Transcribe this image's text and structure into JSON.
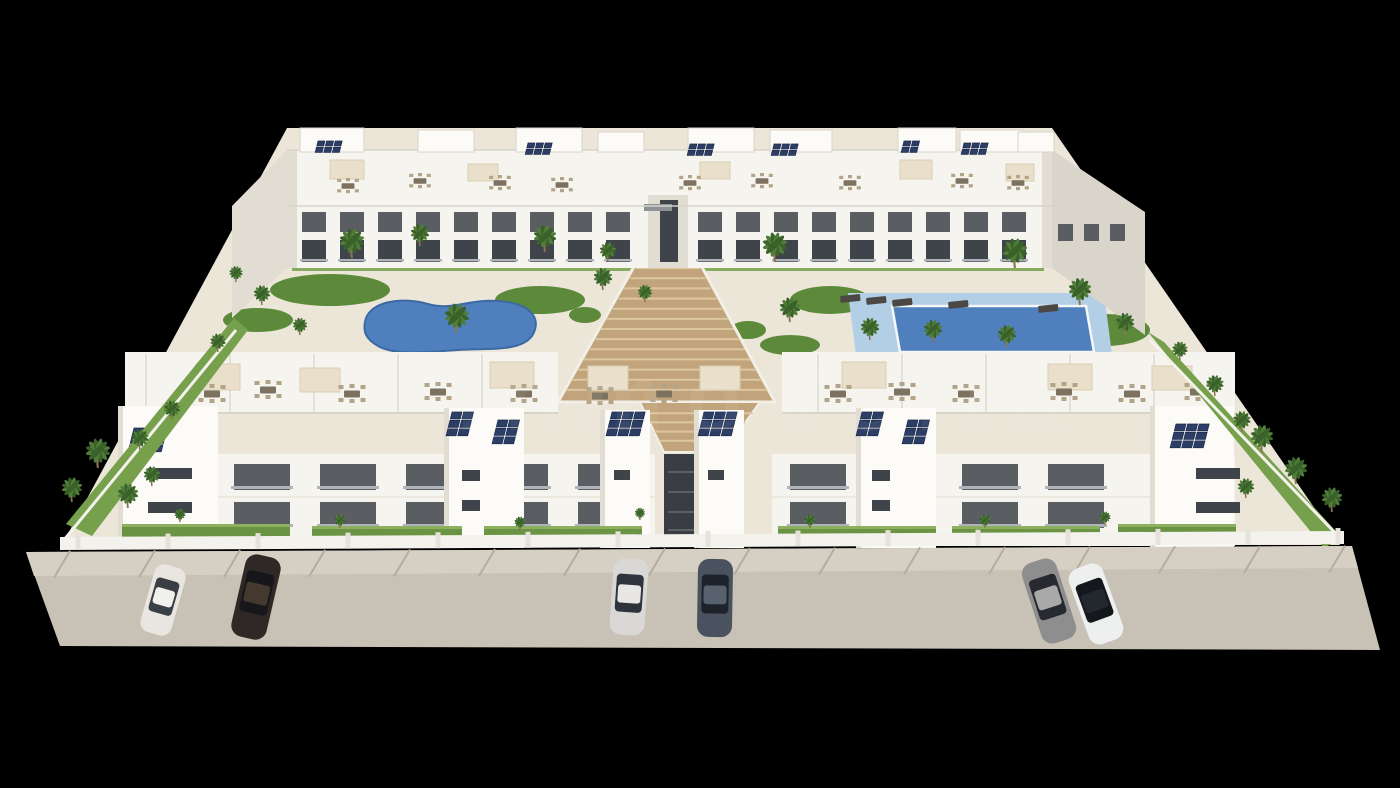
{
  "scene": {
    "description": "3D architectural aerial rendering of a white Mediterranean apartment complex with two swimming pools, landscaped courtyard with palm trees, central timber staircase, rooftop solar panels and terraces, and a street with parked cars, on a black background",
    "watermark": {
      "text": "inmoVella",
      "opacity": 0.06
    }
  },
  "palette": {
    "background": "#000000",
    "building_white": "#f6f4ef",
    "building_bright": "#fcfbf8",
    "building_shade": "#e1ddd3",
    "building_side": "#d9d5cb",
    "parapet_line": "#d7d3ca",
    "facade_opening": "#5a5e63",
    "opening_deep": "#3f434a",
    "railing": "#aeb4ba",
    "deck_cream": "#ece6d9",
    "lawn_green": "#76a04b",
    "lawn_dark": "#5d8a3a",
    "palm_green": "#4f7d39",
    "palm_dark": "#3a6129",
    "palm_trunk": "#8a7254",
    "stairs_wood": "#c2a47c",
    "stairs_step": "#dcc69e",
    "stairs_side": "#f2efe7",
    "pool_water": "#4f80bd",
    "pool_edge": "#3b69a4",
    "pool_rim": "#f4f6f7",
    "pool_deck_blue": "#b2cfe6",
    "solar_panel": "#2c3e66",
    "solar_edge": "#1c2a4a",
    "pergola_cream": "#e9dfca",
    "furniture_tan": "#b3a488",
    "furniture_dark": "#7d7260",
    "lounger_dark": "#4b4742",
    "street_gray": "#c8c1b5",
    "sidewalk_gray": "#d6d0c4",
    "street_joint": "#b4ad9f",
    "wall_white": "#f4f2ec",
    "hedge_green": "#6a9343",
    "hedge_light": "#8db05e",
    "passage_dark": "#3a3e44",
    "watermark_white": "#ffffff"
  },
  "counts": {
    "residential_blocks": 4,
    "swimming_pools": 2,
    "parked_cars": 6,
    "central_staircase": 1
  },
  "objects": {
    "lawn_patches": [
      [
        330,
        290,
        60,
        16
      ],
      [
        540,
        300,
        45,
        14
      ],
      [
        420,
        365,
        70,
        12
      ],
      [
        258,
        320,
        35,
        12
      ],
      [
        830,
        300,
        40,
        14
      ],
      [
        1105,
        330,
        45,
        16
      ],
      [
        940,
        374,
        60,
        10
      ],
      [
        790,
        345,
        30,
        10
      ],
      [
        585,
        315,
        16,
        8
      ],
      [
        748,
        330,
        18,
        9
      ],
      [
        620,
        380,
        14,
        7
      ]
    ],
    "penthouses": [
      [
        300,
        128,
        64,
        24
      ],
      [
        418,
        130,
        56,
        22
      ],
      [
        516,
        128,
        66,
        24
      ],
      [
        598,
        132,
        46,
        20
      ],
      [
        688,
        128,
        66,
        24
      ],
      [
        770,
        130,
        62,
        22
      ],
      [
        898,
        128,
        58,
        24
      ],
      [
        960,
        130,
        64,
        22
      ],
      [
        1018,
        132,
        36,
        20
      ]
    ],
    "solar_back": [
      {
        "x": 318,
        "y": 141,
        "cols": 3,
        "rows": 2,
        "cw": 7,
        "ch": 5
      },
      {
        "x": 528,
        "y": 143,
        "cols": 3,
        "rows": 2,
        "cw": 7,
        "ch": 5
      },
      {
        "x": 690,
        "y": 144,
        "cols": 3,
        "rows": 2,
        "cw": 7,
        "ch": 5
      },
      {
        "x": 774,
        "y": 144,
        "cols": 3,
        "rows": 2,
        "cw": 7,
        "ch": 5
      },
      {
        "x": 904,
        "y": 141,
        "cols": 2,
        "rows": 2,
        "cw": 7,
        "ch": 5
      },
      {
        "x": 964,
        "y": 143,
        "cols": 3,
        "rows": 2,
        "cw": 7,
        "ch": 5
      }
    ],
    "solar_front": [
      {
        "x": 134,
        "y": 428,
        "cols": 3,
        "rows": 3,
        "cw": 10,
        "ch": 7
      },
      {
        "x": 452,
        "y": 412,
        "cols": 2,
        "rows": 3,
        "cw": 10,
        "ch": 7
      },
      {
        "x": 498,
        "y": 420,
        "cols": 2,
        "rows": 3,
        "cw": 10,
        "ch": 7
      },
      {
        "x": 612,
        "y": 412,
        "cols": 3,
        "rows": 3,
        "cw": 10,
        "ch": 7
      },
      {
        "x": 704,
        "y": 412,
        "cols": 3,
        "rows": 3,
        "cw": 10,
        "ch": 7
      },
      {
        "x": 862,
        "y": 412,
        "cols": 2,
        "rows": 3,
        "cw": 10,
        "ch": 7
      },
      {
        "x": 908,
        "y": 420,
        "cols": 2,
        "rows": 3,
        "cw": 10,
        "ch": 7
      },
      {
        "x": 1176,
        "y": 424,
        "cols": 3,
        "rows": 3,
        "cw": 10,
        "ch": 7
      }
    ],
    "window_runs": [
      {
        "x": 302,
        "y": 212,
        "count": 9,
        "dx": 38,
        "w": 24,
        "h": 20,
        "color": "facade_opening",
        "rail": false
      },
      {
        "x": 698,
        "y": 212,
        "count": 9,
        "dx": 38,
        "w": 24,
        "h": 20,
        "color": "facade_opening",
        "rail": false
      },
      {
        "x": 302,
        "y": 240,
        "count": 9,
        "dx": 38,
        "w": 24,
        "h": 22,
        "color": "opening_deep",
        "rail": true
      },
      {
        "x": 698,
        "y": 240,
        "count": 9,
        "dx": 38,
        "w": 24,
        "h": 22,
        "color": "opening_deep",
        "rail": true
      },
      {
        "x": 1058,
        "y": 224,
        "count": 3,
        "dx": 26,
        "w": 15,
        "h": 17,
        "color": "facade_opening",
        "rail": false
      }
    ],
    "balcony_runs": [
      {
        "x": 234,
        "y": 464,
        "count": 5,
        "dx": 86,
        "w": 56,
        "h": 26
      },
      {
        "x": 790,
        "y": 464,
        "count": 4,
        "dx": 86,
        "w": 56,
        "h": 26
      },
      {
        "x": 234,
        "y": 502,
        "count": 5,
        "dx": 86,
        "w": 56,
        "h": 26
      },
      {
        "x": 790,
        "y": 502,
        "count": 4,
        "dx": 86,
        "w": 56,
        "h": 26
      }
    ],
    "tower_strips": [
      [
        444,
        408,
        80,
        140
      ],
      [
        600,
        410,
        50,
        138
      ],
      [
        694,
        410,
        50,
        138
      ],
      [
        856,
        408,
        80,
        140
      ],
      [
        118,
        406,
        100,
        142
      ],
      [
        1150,
        406,
        84,
        142
      ]
    ],
    "tower_windows": [
      [
        148,
        468,
        44,
        11
      ],
      [
        148,
        502,
        44,
        11
      ],
      [
        1196,
        468,
        44,
        11
      ],
      [
        1196,
        502,
        44,
        11
      ],
      [
        462,
        470,
        18,
        11
      ],
      [
        462,
        500,
        18,
        11
      ],
      [
        614,
        470,
        16,
        10
      ],
      [
        708,
        470,
        16,
        10
      ],
      [
        872,
        470,
        18,
        11
      ],
      [
        872,
        500,
        18,
        11
      ]
    ],
    "pergolas_back": [
      [
        330,
        160,
        34,
        19
      ],
      [
        468,
        164,
        30,
        17
      ],
      [
        700,
        162,
        30,
        17
      ],
      [
        900,
        160,
        32,
        19
      ],
      [
        1006,
        164,
        28,
        17
      ]
    ],
    "pergolas_front": [
      [
        196,
        364,
        44,
        26
      ],
      [
        300,
        368,
        40,
        24
      ],
      [
        490,
        362,
        44,
        26
      ],
      [
        588,
        366,
        40,
        24
      ],
      [
        700,
        366,
        40,
        24
      ],
      [
        842,
        362,
        44,
        26
      ],
      [
        1048,
        364,
        44,
        26
      ],
      [
        1152,
        366,
        40,
        24
      ]
    ],
    "furniture_back": [
      [
        348,
        186
      ],
      [
        420,
        181
      ],
      [
        500,
        183
      ],
      [
        562,
        185
      ],
      [
        690,
        183
      ],
      [
        762,
        181
      ],
      [
        850,
        183
      ],
      [
        962,
        181
      ],
      [
        1018,
        183
      ]
    ],
    "furniture_front": [
      [
        212,
        394
      ],
      [
        268,
        390
      ],
      [
        352,
        394
      ],
      [
        438,
        392
      ],
      [
        524,
        394
      ],
      [
        600,
        396
      ],
      [
        664,
        394
      ],
      [
        838,
        394
      ],
      [
        902,
        392
      ],
      [
        966,
        394
      ],
      [
        1064,
        392
      ],
      [
        1132,
        394
      ],
      [
        1198,
        392
      ]
    ],
    "loungers": [
      [
        840,
        296
      ],
      [
        866,
        298
      ],
      [
        892,
        300
      ],
      [
        948,
        302
      ],
      [
        1038,
        306
      ],
      [
        408,
        356
      ],
      [
        432,
        359
      ]
    ],
    "palms": [
      [
        352,
        258,
        24
      ],
      [
        420,
        246,
        18
      ],
      [
        545,
        252,
        22
      ],
      [
        608,
        262,
        16
      ],
      [
        775,
        262,
        24
      ],
      [
        1015,
        268,
        24
      ],
      [
        457,
        333,
        24
      ],
      [
        603,
        290,
        18
      ],
      [
        645,
        302,
        14
      ],
      [
        790,
        322,
        20
      ],
      [
        870,
        340,
        18
      ],
      [
        933,
        342,
        18
      ],
      [
        1007,
        347,
        18
      ],
      [
        1080,
        305,
        22
      ],
      [
        1125,
        335,
        18
      ],
      [
        262,
        305,
        16
      ],
      [
        300,
        335,
        14
      ],
      [
        236,
        282,
        13
      ],
      [
        218,
        352,
        15
      ],
      [
        172,
        420,
        16
      ],
      [
        140,
        450,
        17
      ],
      [
        1180,
        360,
        15
      ],
      [
        1215,
        396,
        17
      ],
      [
        1242,
        432,
        17
      ],
      [
        98,
        468,
        24
      ],
      [
        72,
        502,
        20
      ],
      [
        128,
        508,
        20
      ],
      [
        152,
        486,
        16
      ],
      [
        1262,
        452,
        22
      ],
      [
        1296,
        484,
        22
      ],
      [
        1332,
        512,
        20
      ],
      [
        1246,
        498,
        16
      ],
      [
        180,
        522,
        11
      ],
      [
        340,
        528,
        11
      ],
      [
        520,
        530,
        11
      ],
      [
        810,
        528,
        11
      ],
      [
        985,
        528,
        11
      ],
      [
        1105,
        525,
        11
      ],
      [
        640,
        520,
        10
      ]
    ],
    "hedges": [
      [
        122,
        524,
        168
      ],
      [
        312,
        526,
        150
      ],
      [
        484,
        526,
        158
      ],
      [
        778,
        526,
        158
      ],
      [
        952,
        526,
        148
      ],
      [
        1118,
        524,
        118
      ]
    ],
    "stair_flights": [
      {
        "top_x1": 642,
        "top_x2": 694,
        "top_y": 258,
        "bot_x1": 560,
        "bot_x2": 773,
        "bot_y": 400,
        "steps": 14
      },
      {
        "top_x1": 640,
        "top_x2": 760,
        "top_y": 404,
        "bot_x1": 664,
        "bot_x2": 724,
        "bot_y": 450,
        "steps": 5
      }
    ],
    "terrace_dividers": {
      "x0": 146,
      "dx": 84,
      "count": 14
    },
    "street_joints": {
      "x0": 70,
      "dx": 85,
      "count": 16
    },
    "wall_posts": {
      "x0": 78,
      "dx": 90,
      "count": 15
    },
    "cars": [
      {
        "x": 163,
        "y": 600,
        "angle": 16,
        "w": 32,
        "len": 70,
        "body": "#e9e6e1",
        "glass": "#3a3f45",
        "roof": "#f2f0ec",
        "name": "white-sedan-left"
      },
      {
        "x": 256,
        "y": 597,
        "angle": 13,
        "w": 36,
        "len": 84,
        "body": "#2f2826",
        "glass": "#17161a",
        "roof": "#43392f",
        "name": "dark-brown-suv"
      },
      {
        "x": 629,
        "y": 597,
        "angle": 4,
        "w": 35,
        "len": 76,
        "body": "#d9d8d6",
        "glass": "#2e343c",
        "roof": "#e8e7e5",
        "name": "silver-sedan-center"
      },
      {
        "x": 715,
        "y": 598,
        "angle": 1,
        "w": 35,
        "len": 78,
        "body": "#49525e",
        "glass": "#1d232b",
        "roof": "#57626e",
        "name": "slate-blue-sedan-center"
      },
      {
        "x": 1049,
        "y": 601,
        "angle": -18,
        "w": 36,
        "len": 84,
        "body": "#8e8e8e",
        "glass": "#26292e",
        "roof": "#a9a9a9",
        "name": "gray-sedan-right"
      },
      {
        "x": 1096,
        "y": 604,
        "angle": -20,
        "w": 36,
        "len": 80,
        "body": "#eef0f0",
        "glass": "#14171c",
        "roof": "#23282e",
        "name": "white-sedan-right"
      }
    ]
  }
}
